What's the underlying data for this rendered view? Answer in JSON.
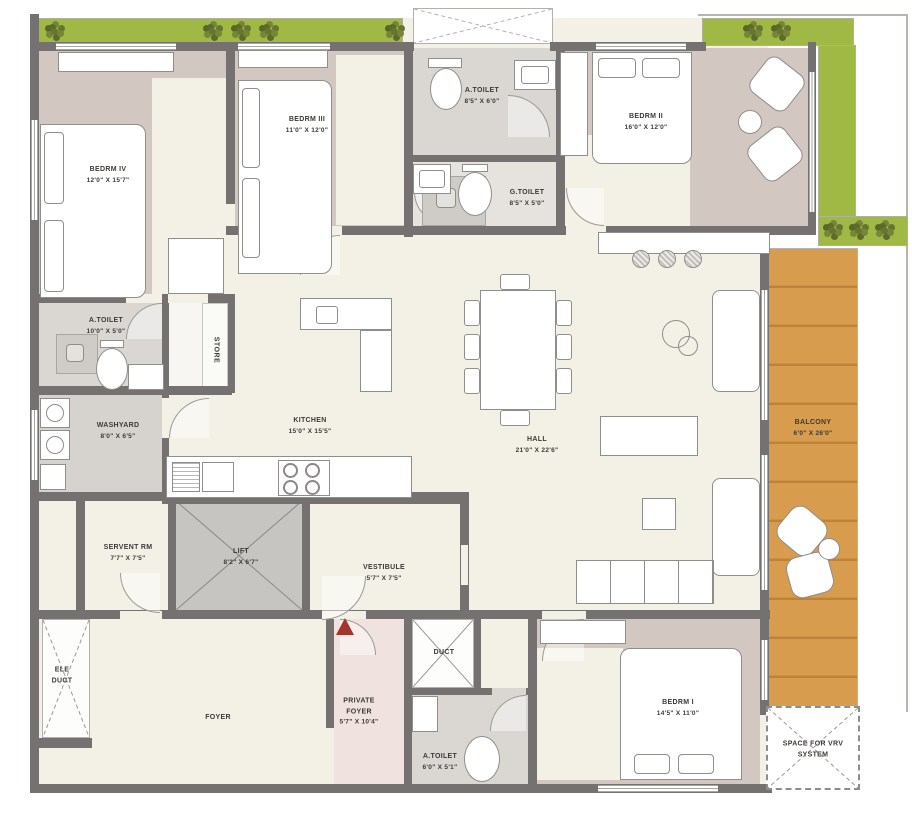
{
  "plan": {
    "rooms": {
      "bedrm4": {
        "name": "BEDRM IV",
        "dims": "12'0\" X 15'7\""
      },
      "bedrm3": {
        "name": "BEDRM III",
        "dims": "11'0\" X 12'0\""
      },
      "atoilet_top": {
        "name": "A.TOILET",
        "dims": "8'5\" X 6'0\""
      },
      "gtoilet": {
        "name": "G.TOILET",
        "dims": "8'5\" X 5'0\""
      },
      "bedrm2": {
        "name": "BEDRM II",
        "dims": "16'0\" X 12'0\""
      },
      "atoilet_left": {
        "name": "A.TOILET",
        "dims": "10'0\" X 5'0\""
      },
      "store": {
        "name": "STORE"
      },
      "washyard": {
        "name": "WASHYARD",
        "dims": "8'0\" X 6'5\""
      },
      "kitchen": {
        "name": "KITCHEN",
        "dims": "15'0\" X 15'5\""
      },
      "hall": {
        "name": "HALL",
        "dims": "21'0\" X 22'6\""
      },
      "balcony": {
        "name": "BALCONY",
        "dims": "6'0\" X 26'0\""
      },
      "servant": {
        "name": "SERVENT RM",
        "dims": "7'7\" X 7'5\""
      },
      "lift": {
        "name": "LIFT",
        "dims": "8'2\" X 6'7\""
      },
      "vestibule": {
        "name": "VESTIBULE",
        "dims": "5'7\" X 7'5\""
      },
      "ele_duct": {
        "name": "ELE DUCT"
      },
      "foyer": {
        "name": "FOYER"
      },
      "private_foyer": {
        "name": "PRIVATE FOYER",
        "dims": "5'7\" X 10'4\""
      },
      "duct": {
        "name": "DUCT"
      },
      "atoilet_bottom": {
        "name": "A.TOILET",
        "dims": "6'0\" X 5'1\""
      },
      "bedrm1": {
        "name": "BEDRM I",
        "dims": "14'5\" X 11'0\""
      },
      "vrv": {
        "name": "SPACE FOR VRV SYSTEM"
      }
    },
    "colors": {
      "wall": "#747170",
      "floor_cream": "#f3f0e6",
      "floor_mauve": "#d3c7c2",
      "floor_gray": "#dad7d3",
      "planter_green": "#9fb944",
      "balcony_wood": "#d89c4e",
      "private_foyer_pink": "#f0e2de",
      "entry_arrow_red": "#a5342c"
    }
  }
}
